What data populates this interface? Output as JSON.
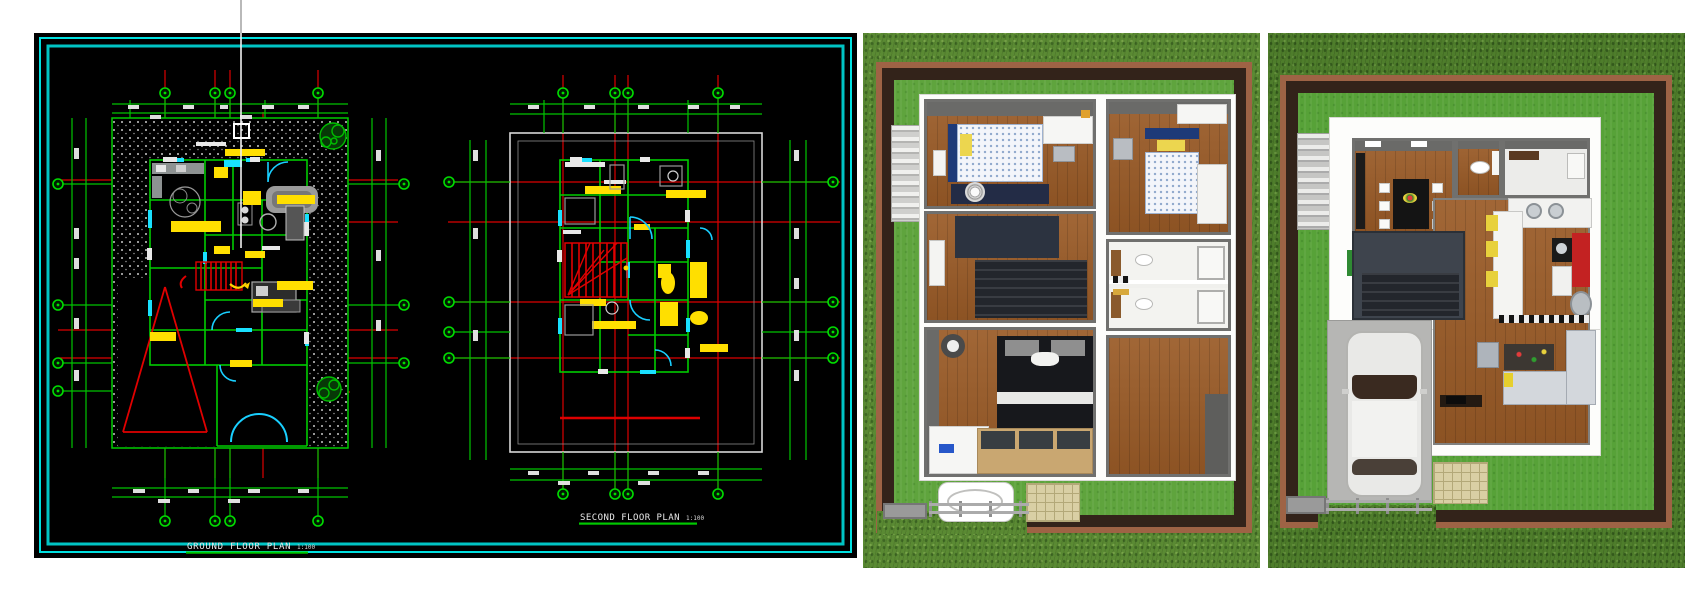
{
  "cad": {
    "ground_title": "GROUND FLOOR PLAN",
    "ground_scale": "1:100",
    "second_title": "SECOND FLOOR PLAN",
    "second_scale": "1:100",
    "colors": {
      "background": "#000000",
      "border_cyan": "#00e0e0",
      "wall_green": "#00cc00",
      "grid_red": "#dd0000",
      "label_yellow": "#ffdd00",
      "door_cyan": "#00d5ff",
      "dim_text": "#e8e8e8"
    }
  },
  "render_second_floor": {
    "colors": {
      "outer_grass": "#5a8a33",
      "lawn": "#5fa43d",
      "fence_brick": "#9e6345",
      "fence_wall": "#33231a",
      "floor_wood": "#9a5b27",
      "wall_gray": "#70706e",
      "bed_quilt_dot": "#8fa8cc",
      "headboard_navy": "#1e3a78",
      "pillow_yellow": "#ecd64f"
    }
  },
  "render_ground_floor": {
    "colors": {
      "outer_grass": "#4e7d2b",
      "lawn": "#57a238",
      "fence_brick": "#9e6345",
      "fence_wall": "#33231a",
      "floor_wood": "#9a5b27",
      "carport": "#b6b6b4",
      "car_body": "#e9e9e7",
      "cabinet_red": "#c32222",
      "accent_yellow": "#e8d13c"
    }
  }
}
